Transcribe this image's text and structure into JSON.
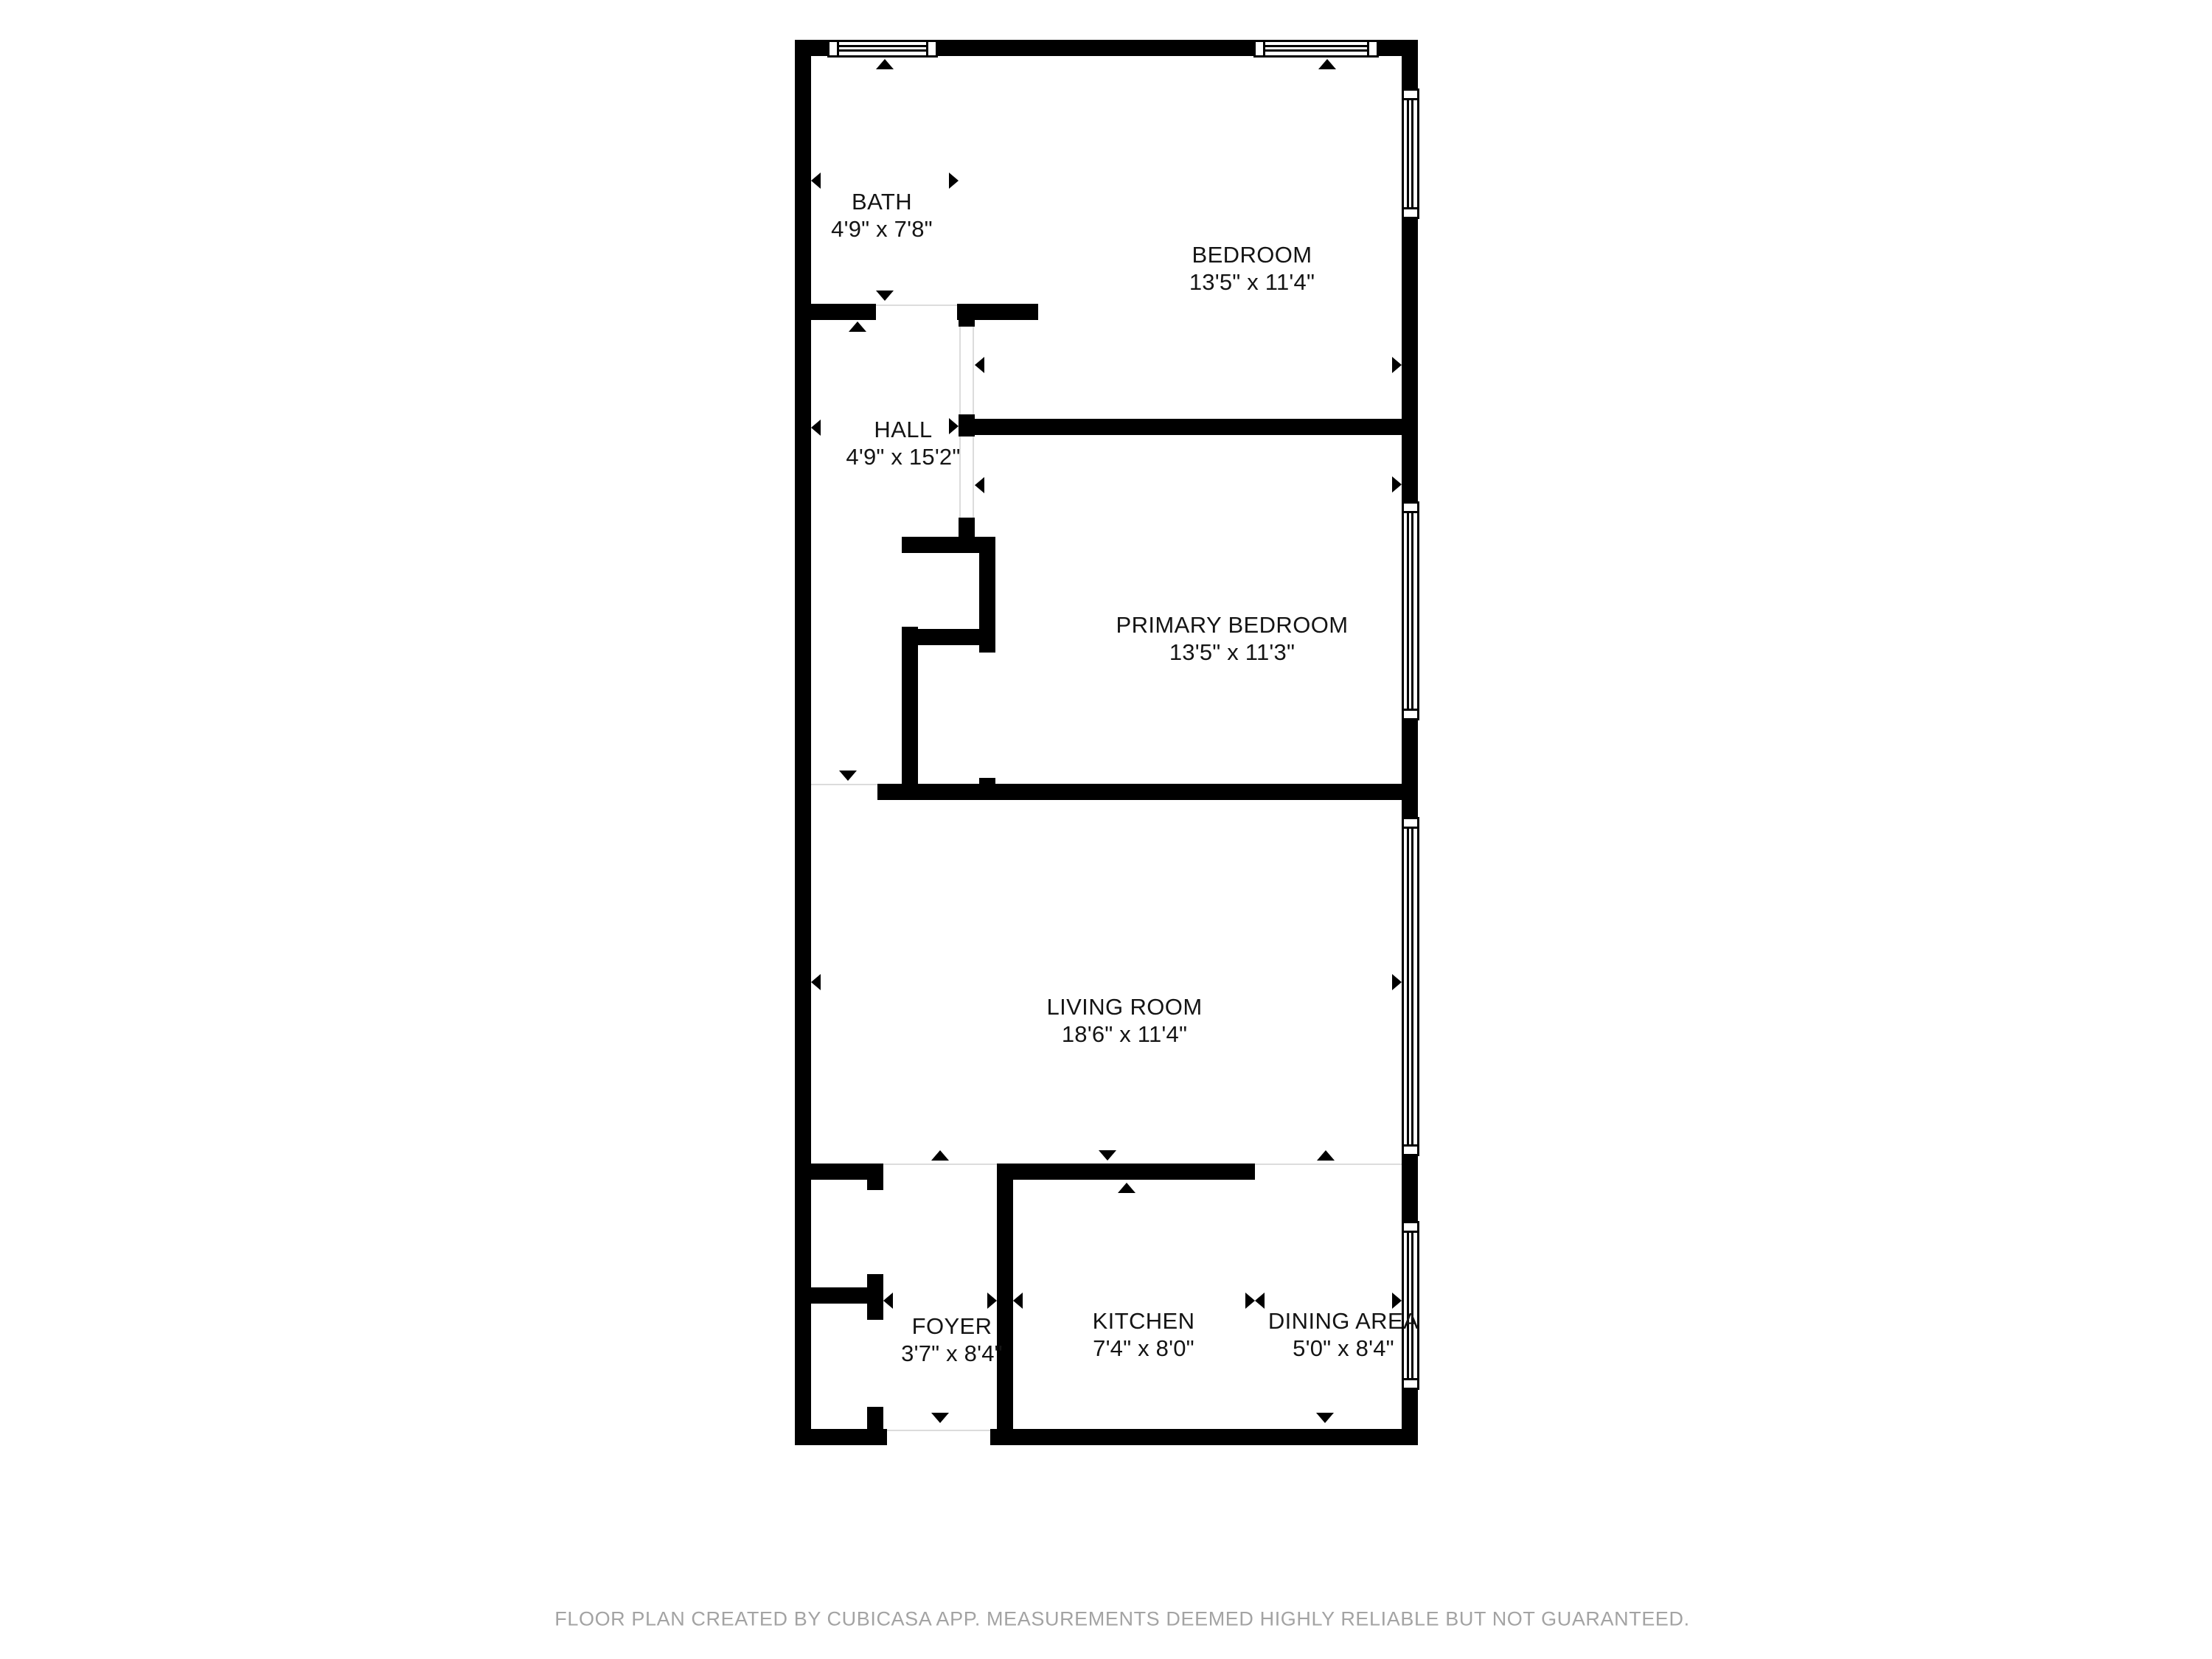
{
  "plan": {
    "rooms": [
      {
        "name": "BATH",
        "dims": "4'9\" x 7'8\""
      },
      {
        "name": "BEDROOM",
        "dims": "13'5\" x 11'4\""
      },
      {
        "name": "HALL",
        "dims": "4'9\" x 15'2\""
      },
      {
        "name": "PRIMARY BEDROOM",
        "dims": "13'5\" x 11'3\""
      },
      {
        "name": "LIVING ROOM",
        "dims": "18'6\" x 11'4\""
      },
      {
        "name": "FOYER",
        "dims": "3'7\" x 8'4\""
      },
      {
        "name": "KITCHEN",
        "dims": "7'4\" x 8'0\""
      },
      {
        "name": "DINING AREA",
        "dims": "5'0\" x 8'4\""
      }
    ],
    "footer": "FLOOR PLAN CREATED BY CUBICASA APP. MEASUREMENTS DEEMED HIGHLY RELIABLE BUT NOT GUARANTEED."
  },
  "colors": {
    "wall": "#000000",
    "floor": "#ffffff",
    "label_text": "#141414",
    "footer_text": "#a3a3a3"
  }
}
